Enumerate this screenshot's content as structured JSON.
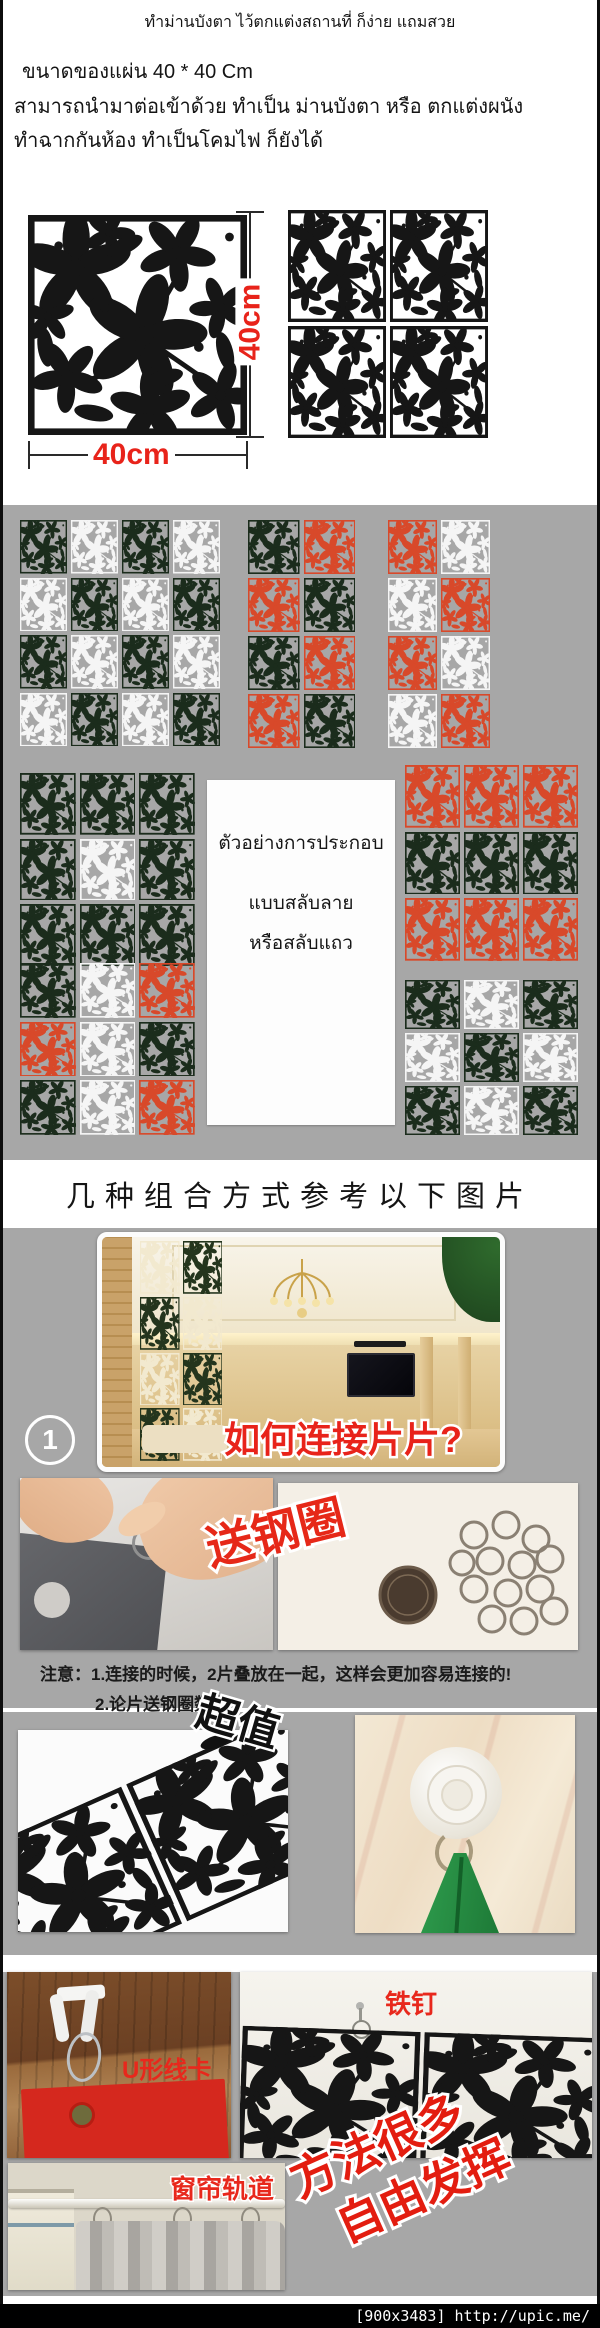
{
  "colors": {
    "section_bg": "#a7a7a7",
    "accent_red": "#e8231a",
    "footer_bg": "#000000",
    "palette": {
      "K": "#161616",
      "G": "#1b2c1c",
      "R": "#d8492a",
      "W": "#f5f5f5",
      "I": "#f2e9cf",
      "D": "#24351d"
    }
  },
  "intro": {
    "title": "ทำม่านบังตา  ไว้ตกแต่งสถานที่ ก็ง่าย  แถมสวย",
    "size_line": "ขนาดของแผ่น   40  * 40  Cm",
    "desc_line1": "สามารถนำมาต่อเข้าด้วย  ทำเป็น ม่านบังตา  หรือ ตกแต่งผนัง",
    "desc_line2": "ทำฉากกันห้อง    ทำเป็นโคมไฟ ก็ยังได้"
  },
  "dimension": {
    "width_label": "40cm",
    "height_label": "40cm"
  },
  "assembly_card": {
    "line1": "ตัวอย่างการประกอบ",
    "line2": "แบบสลับลาย",
    "line3": "หรือสลับแถว"
  },
  "combo_title": "几种组合方式参考以下图片",
  "step": {
    "number": "1",
    "question": "如何连接片片?"
  },
  "labels": {
    "free_rings": "送钢圈",
    "super_value": "超值",
    "iron_nail": "铁钉",
    "u_clip": "U形线卡",
    "curtain_track": "窗帘轨道",
    "many_ways": "方法很多",
    "freestyle": "自由发挥"
  },
  "notes": {
    "line1": "注意：1.连接的时候，2片叠放在一起，这样会更加容易连接的!",
    "line2": "2.论片送钢圈数量"
  },
  "footer": {
    "watermark": "[900x3483] http://upic.me/"
  },
  "grids": {
    "product_2x2": {
      "cols": 2,
      "rows": [
        "KK",
        "KK"
      ]
    },
    "checker_4x4": {
      "cols": 4,
      "rows": [
        "GWGW",
        "WGWG",
        "GWGW",
        "WGWG"
      ]
    },
    "duo_gr": {
      "cols": 2,
      "rows": [
        "GR",
        "RG",
        "GR",
        "RG"
      ]
    },
    "duo_rw": {
      "cols": 2,
      "rows": [
        "RW",
        "WR",
        "RW",
        "WR"
      ]
    },
    "block_green": {
      "cols": 3,
      "rows": [
        "GGG",
        "GWG",
        "GGG"
      ]
    },
    "rows_rgr": {
      "cols": 3,
      "rows": [
        "RRR",
        "GGG",
        "RRR"
      ]
    },
    "mix_left": {
      "cols": 3,
      "rows": [
        "GWR",
        "RWG",
        "GWR"
      ]
    },
    "checker_3x3": {
      "cols": 3,
      "rows": [
        "GWG",
        "WGW",
        "GWG"
      ]
    },
    "screen_2x4": {
      "cols": 2,
      "rows": [
        "ID",
        "DI",
        "ID",
        "DI"
      ]
    },
    "wall_panel": {
      "cols": 2,
      "rows": [
        "KK"
      ]
    },
    "lace_pair": {
      "cols": 2,
      "rows": [
        "KK"
      ]
    }
  }
}
